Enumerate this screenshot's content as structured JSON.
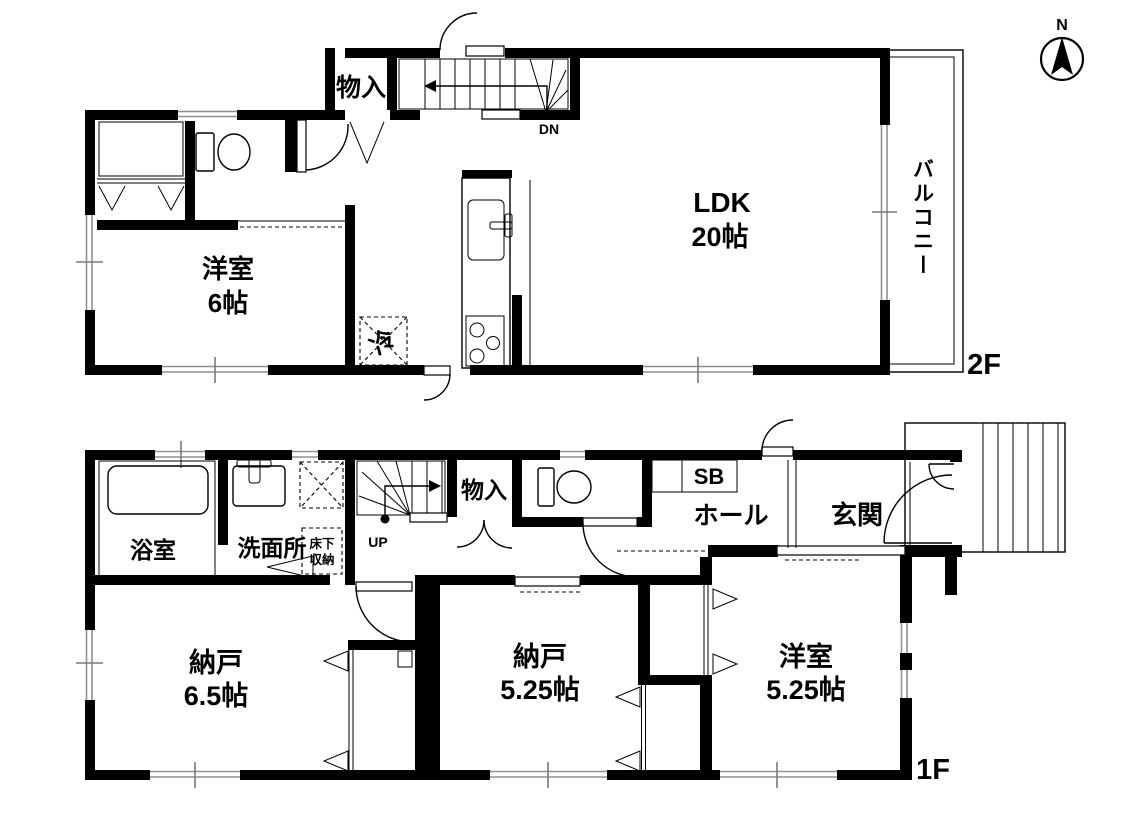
{
  "compass": {
    "north_label": "N"
  },
  "floor_2": {
    "floor_label": "2F",
    "rooms": {
      "ldk": {
        "name": "LDK",
        "size": "20帖"
      },
      "western_room": {
        "name": "洋室",
        "size": "6帖"
      },
      "storage": {
        "name": "物入"
      },
      "balcony": {
        "name": "バルコニー"
      }
    },
    "fixtures": {
      "refrigerator": "冷"
    },
    "stairs": {
      "direction_label": "DN"
    }
  },
  "floor_1": {
    "floor_label": "1F",
    "rooms": {
      "bathroom": {
        "name": "浴室"
      },
      "washroom": {
        "name": "洗面所"
      },
      "hall": {
        "name": "ホール"
      },
      "entrance": {
        "name": "玄関"
      },
      "storage": {
        "name": "物入"
      },
      "shoe_box": {
        "name": "SB"
      },
      "storage_room_1": {
        "name": "納戸",
        "size": "6.5帖"
      },
      "storage_room_2": {
        "name": "納戸",
        "size": "5.25帖"
      },
      "western_room": {
        "name": "洋室",
        "size": "5.25帖"
      }
    },
    "fixtures": {
      "underfloor_storage_line1": "床下",
      "underfloor_storage_line2": "収納"
    },
    "stairs": {
      "direction_label": "UP"
    }
  }
}
